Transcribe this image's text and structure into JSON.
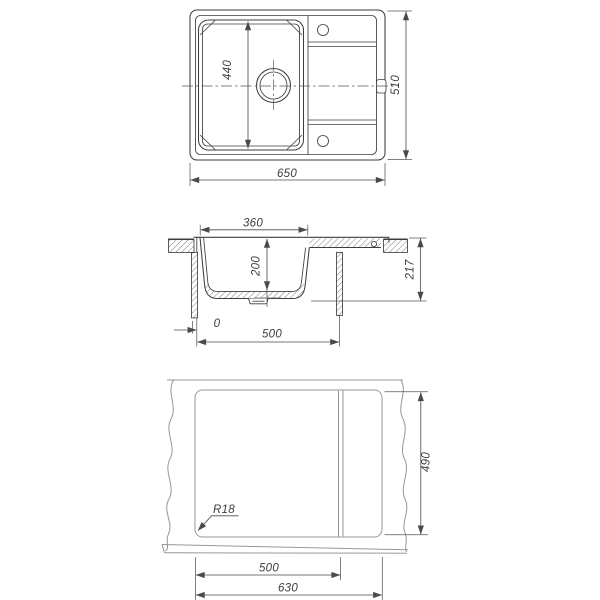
{
  "colors": {
    "background": "#ffffff",
    "object_line": "#3e3e3e",
    "dimension_line": "#4a4a4a",
    "light_object_line": "#979797",
    "text": "#3c3c3c"
  },
  "top_view": {
    "overall_width": "650",
    "overall_depth": "510",
    "bowl_length": "440"
  },
  "section_view": {
    "bowl_top_width": "360",
    "bowl_depth": "200",
    "overall_height": "217",
    "edge_offset": "0",
    "underside_width": "500"
  },
  "cutout_view": {
    "corner_radius": "R18",
    "cutout_depth": "490",
    "cutout_partial_width": "500",
    "cutout_width": "630"
  }
}
